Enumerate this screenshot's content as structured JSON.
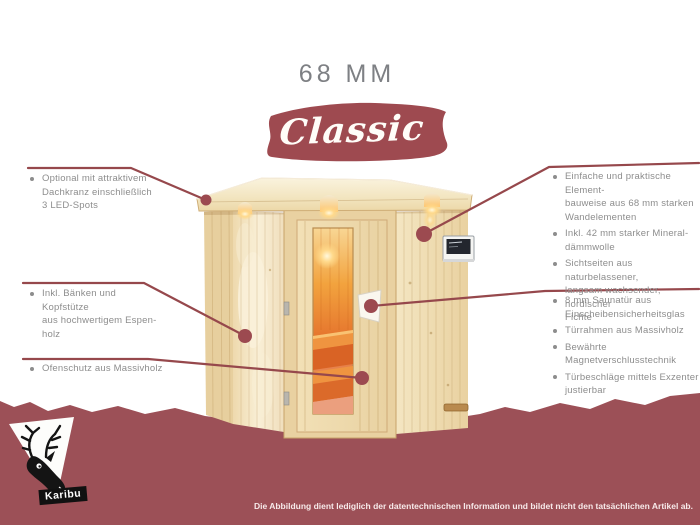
{
  "title": "68 MM",
  "product_line": "Classic",
  "annotations": {
    "left": [
      {
        "id": "led-spots",
        "text": "Optional mit attraktivem\nDachkranz einschließlich\n3 LED-Spots"
      },
      {
        "id": "baenke",
        "text": "Inkl. Bänken und Kopfstütze\naus hochwertigem Espen-\nholz"
      },
      {
        "id": "ofenschutz",
        "text": "Ofenschutz aus Massivholz"
      }
    ],
    "right_top": [
      {
        "id": "elementbauweise",
        "text": "Einfache und praktische Element-\nbauweise aus 68 mm starken\nWandelementen"
      },
      {
        "id": "daemmwolle",
        "text": "Inkl. 42 mm starker Mineral-\ndämmwolle"
      },
      {
        "id": "sichtseiten",
        "text": "Sichtseiten aus naturbelassener,\nlangsam wachsender, nordischer\nFichte"
      }
    ],
    "right_bottom": [
      {
        "id": "saunatuer",
        "text": "8 mm Saunatür aus\nEinscheibensicherheitsglas"
      },
      {
        "id": "tuerrahmen",
        "text": "Türrahmen aus Massivholz"
      },
      {
        "id": "magnetverschluss",
        "text": "Bewährte Magnetverschlusstechnik"
      },
      {
        "id": "tuerbeschlaege",
        "text": "Türbeschläge mittels Exzenter\njustierbar"
      }
    ]
  },
  "footer": {
    "brand": "Karibu",
    "disclaimer": "Die Abbildung dient lediglich der datentechnischen Information und bildet nicht den tatsächlichen Artikel ab."
  },
  "icons": {
    "logo": "deer-icon",
    "bullets": "bullet-dot-icon",
    "callout_markers": "leader-dot-icon"
  },
  "colors": {
    "maroon_banner": "#9c5057",
    "maroon_brush": "#9e4a50",
    "leader_line": "#96484c",
    "annotation_gray": "#8d8d8d",
    "title_gray": "#7e8084",
    "wood_light": "#f3e4bf",
    "wood_dark": "#e9d2a2",
    "glass_orange": "#e8832f"
  }
}
